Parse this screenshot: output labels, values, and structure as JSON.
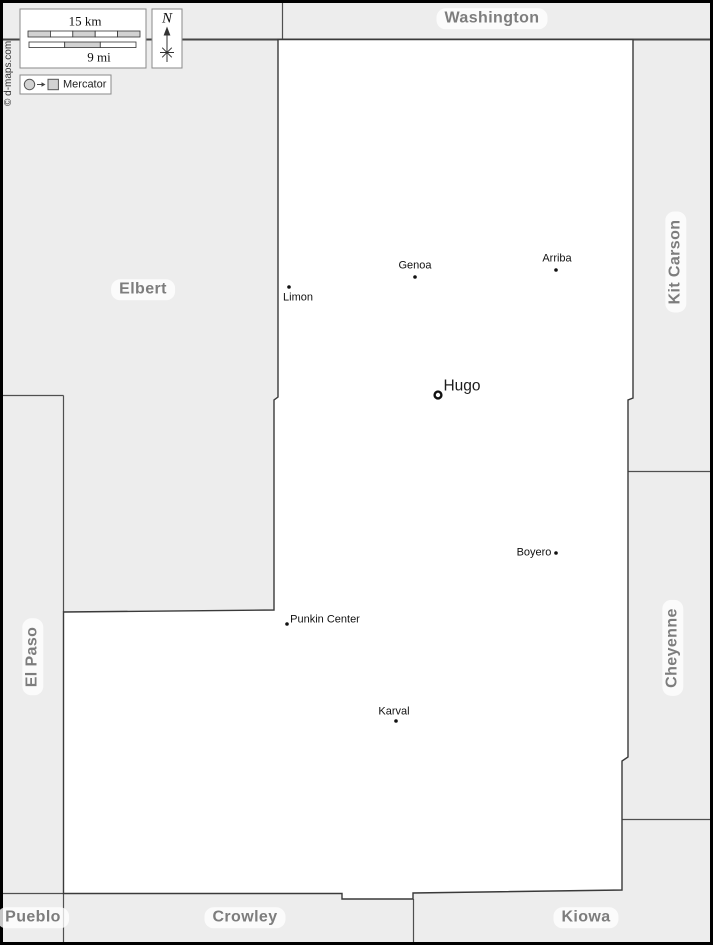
{
  "colors": {
    "background": "#ededed",
    "county_fill": "#ffffff",
    "boundary_stroke": "#3f3f3f",
    "neighbor_stroke": "#4f4f4f",
    "county_label_text": "#7d7d7d",
    "town_label_text": "#111111",
    "frame": "#000000"
  },
  "legend": {
    "scale_km": "15 km",
    "scale_mi": "9 mi",
    "north": "N",
    "projection": "Mercator"
  },
  "copyright": "© d-maps.com",
  "counties": {
    "washington": "Washington",
    "kit_carson": "Kit Carson",
    "cheyenne": "Cheyenne",
    "kiowa": "Kiowa",
    "crowley": "Crowley",
    "pueblo": "Pueblo",
    "el_paso": "El Paso",
    "elbert": "Elbert"
  },
  "towns": {
    "limon": "Limon",
    "genoa": "Genoa",
    "arriba": "Arriba",
    "hugo": "Hugo",
    "boyero": "Boyero",
    "punkin_center": "Punkin Center",
    "karval": "Karval"
  }
}
